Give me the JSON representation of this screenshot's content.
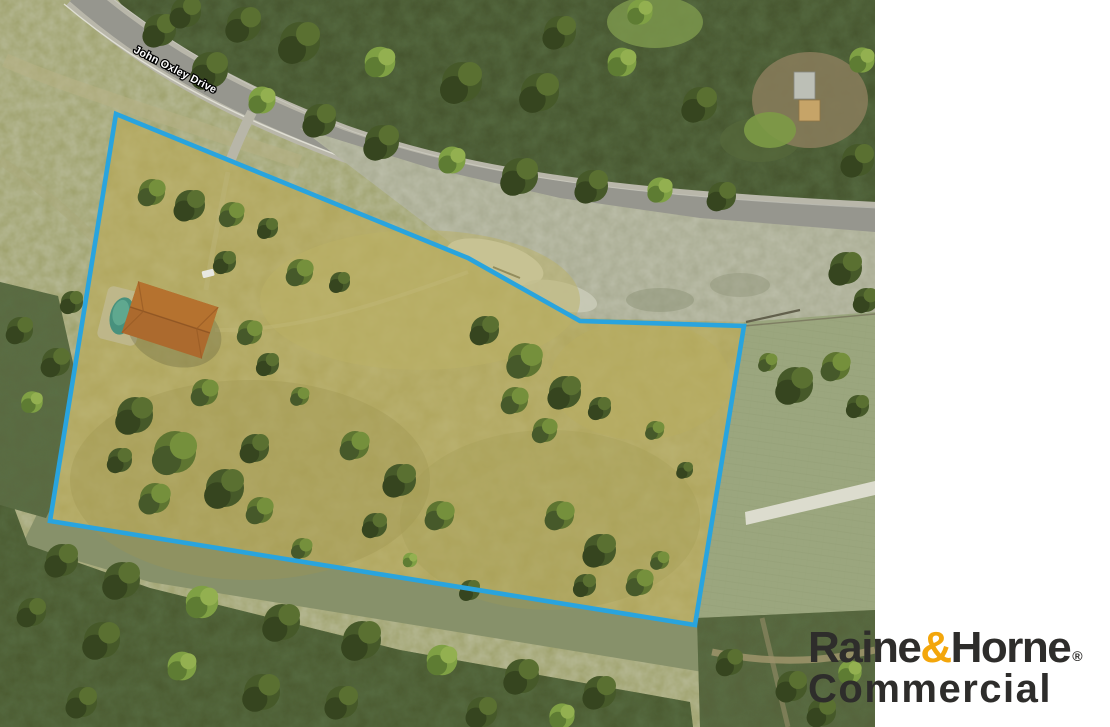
{
  "map": {
    "road_label": "John Oxley Drive",
    "boundary": {
      "color": "#29A4DE",
      "points": "116,114 468,258 580,321 744,326 695,625 50,521"
    }
  },
  "branding": {
    "name_part1": "Raine",
    "ampersand": "&",
    "name_part2": "Horne",
    "registered_mark": "®",
    "division": "Commercial",
    "colors": {
      "charcoal": "#2E2D2B",
      "gold": "#F3A60B"
    }
  }
}
